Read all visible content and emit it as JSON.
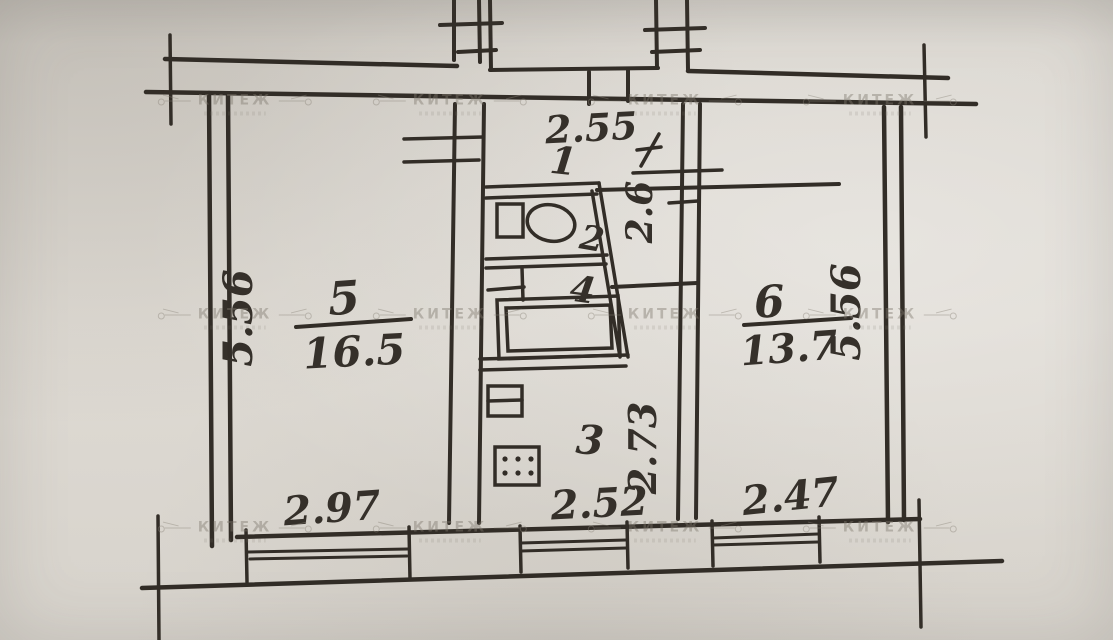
{
  "watermark": {
    "text": "КИТЕЖ"
  },
  "plan": {
    "ink_color": "#322d27",
    "paper_color": "#d9d5ce",
    "rooms": {
      "room5": {
        "number": "5",
        "area": "16.5",
        "width": "2.97",
        "height": "5.56"
      },
      "room6": {
        "number": "6",
        "area": "13.7",
        "width": "2.47",
        "height": "5.56"
      },
      "hall": {
        "number": "1",
        "width": "2.55",
        "depth": "2.6"
      },
      "toilet": {
        "number": "2"
      },
      "bath": {
        "number": "4"
      },
      "kitchen": {
        "number": "3",
        "width": "2.52",
        "depth": "2.73"
      }
    }
  }
}
